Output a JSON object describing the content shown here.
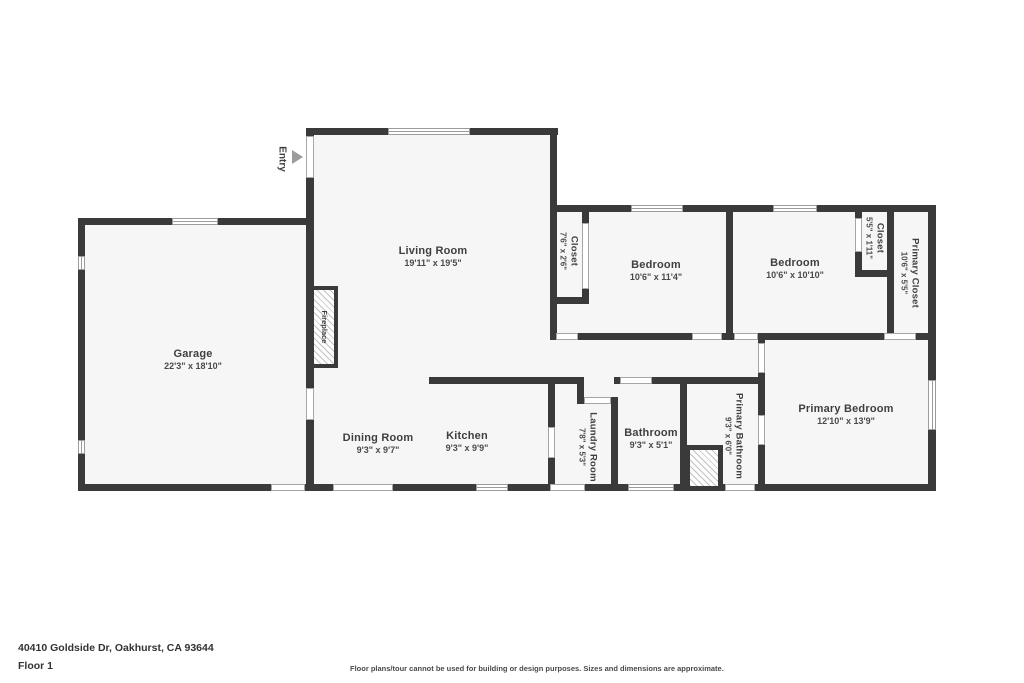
{
  "colors": {
    "wall": "#3a3a3a",
    "floor_fill": "#f6f6f6",
    "label_text": "#3f3f3f",
    "window_outline": "#9b9b9b",
    "entry_arrow": "#9c9c9c"
  },
  "rooms": {
    "garage": {
      "name": "Garage",
      "dims": "22'3\" x 18'10\""
    },
    "living_room": {
      "name": "Living Room",
      "dims": "19'11\" x 19'5\""
    },
    "dining_room": {
      "name": "Dining Room",
      "dims": "9'3\" x 9'7\""
    },
    "kitchen": {
      "name": "Kitchen",
      "dims": "9'3\" x 9'9\""
    },
    "bedroom1": {
      "name": "Bedroom",
      "dims": "10'6\" x 11'4\""
    },
    "bedroom2": {
      "name": "Bedroom",
      "dims": "10'6\" x 10'10\""
    },
    "primary_bedroom": {
      "name": "Primary Bedroom",
      "dims": "12'10\" x 13'9\""
    },
    "bathroom": {
      "name": "Bathroom",
      "dims": "9'3\" x 5'1\""
    },
    "laundry": {
      "name": "Laundry Room",
      "dims": "7'8\" x 5'3\""
    },
    "primary_bathroom": {
      "name": "Primary Bathroom",
      "dims": "9'3\" x 6'0\""
    },
    "closet_hall": {
      "name": "Closet",
      "dims": "7'6\" x 2'6\""
    },
    "closet_bed2": {
      "name": "Closet",
      "dims": "5'5\" x 1'11\""
    },
    "primary_closet": {
      "name": "Primary Closet",
      "dims": "10'6\" x 5'5\""
    }
  },
  "annotations": {
    "entry": "Entry",
    "fireplace": "Fireplace"
  },
  "footer": {
    "address": "40410 Goldside Dr, Oakhurst, CA 93644",
    "floor": "Floor 1",
    "disclaimer": "Floor plans/tour cannot be used for building or design purposes. Sizes and dimensions are approximate."
  }
}
